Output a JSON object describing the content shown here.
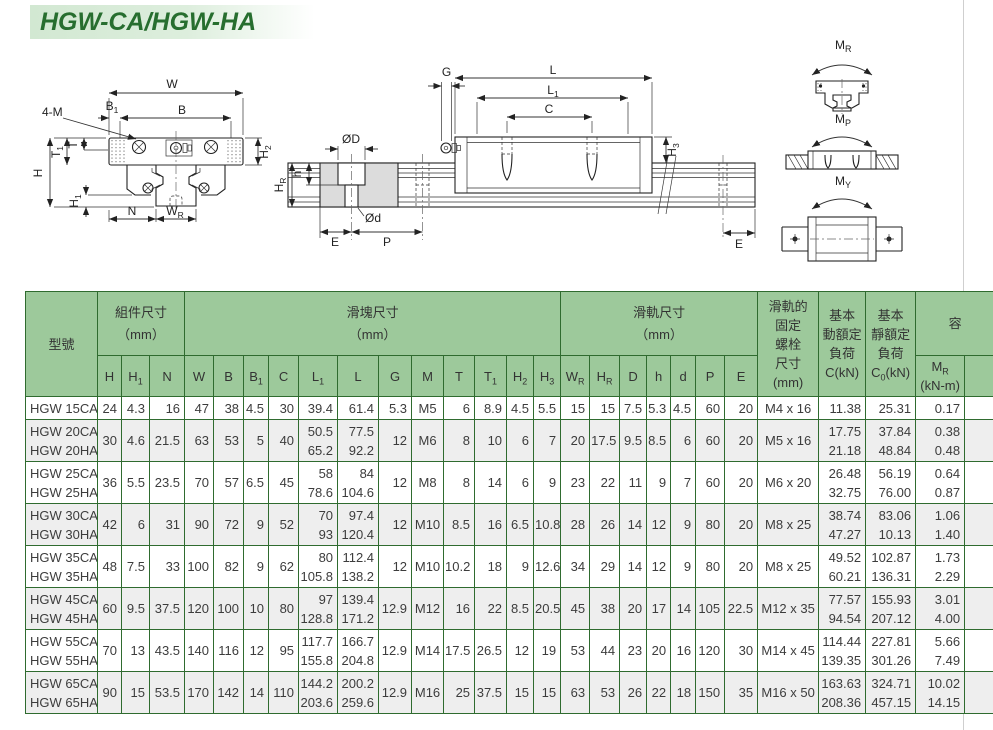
{
  "page": {
    "title": "HGW-CA/HGW-HA"
  },
  "colors": {
    "header_green": "#9dc99b",
    "border_green": "#2f6b2f",
    "row_alt_gray": "#eeeeee",
    "title_green": "#276e2f",
    "title_bg": "#d2e8d2"
  },
  "drawings": {
    "front": {
      "four_m": "4-M",
      "w": "W",
      "b": "B",
      "b1": {
        "b": "B",
        "s": "1"
      },
      "h2": {
        "b": "H",
        "s": "2"
      },
      "t": "T",
      "t1": {
        "b": "T",
        "s": "1"
      },
      "h": "H",
      "h1": {
        "b": "H",
        "s": "1"
      },
      "n": "N",
      "wr": {
        "b": "W",
        "s": "R"
      }
    },
    "side": {
      "g": "G",
      "l": "L",
      "l1": {
        "b": "L",
        "s": "1"
      },
      "c": "C",
      "h3": {
        "b": "H",
        "s": "3"
      },
      "dia_big": "ØD",
      "h_small": "h",
      "dia_small": "Ød",
      "hr": {
        "b": "H",
        "s": "R"
      },
      "e_left": "E",
      "p": "P",
      "e_right": "E"
    },
    "moments": {
      "mr": {
        "b": "M",
        "s": "R"
      },
      "mp": {
        "b": "M",
        "s": "P"
      },
      "my": {
        "b": "M",
        "s": "Y"
      }
    }
  },
  "table": {
    "headers": {
      "model": "型號",
      "assembly": [
        "組件尺寸",
        "（mm）"
      ],
      "block": [
        "滑塊尺寸",
        "（mm）"
      ],
      "rail": [
        "滑軌尺寸",
        "（mm）"
      ],
      "bolt": [
        "滑軌的",
        "固定",
        "螺栓",
        "尺寸",
        "(mm)"
      ],
      "dyn": [
        "基本",
        "動額定",
        "負荷",
        "C(kN)"
      ],
      "stat": [
        "基本",
        "靜額定",
        "負荷"
      ],
      "stat_c": {
        "base": "C",
        "sub": "0",
        "rest": "(kN)"
      },
      "moment": "容",
      "mr": {
        "base": "M",
        "sub": "R",
        "unit": "(kN-m)"
      },
      "sub": [
        {
          "b": "H"
        },
        {
          "b": "H",
          "s": "1"
        },
        {
          "b": "N"
        },
        {
          "b": "W"
        },
        {
          "b": "B"
        },
        {
          "b": "B",
          "s": "1"
        },
        {
          "b": "C"
        },
        {
          "b": "L",
          "s": "1"
        },
        {
          "b": "L"
        },
        {
          "b": "G"
        },
        {
          "b": "M"
        },
        {
          "b": "T"
        },
        {
          "b": "T",
          "s": "1"
        },
        {
          "b": "H",
          "s": "2"
        },
        {
          "b": "H",
          "s": "3"
        },
        {
          "b": "W",
          "s": "R"
        },
        {
          "b": "H",
          "s": "R"
        },
        {
          "b": "D"
        },
        {
          "b": "h"
        },
        {
          "b": "d"
        },
        {
          "b": "P"
        },
        {
          "b": "E"
        }
      ]
    },
    "rows": [
      {
        "model": [
          "HGW 15CA"
        ],
        "dims": [
          [
            "24"
          ],
          [
            "4.3"
          ],
          [
            "16"
          ],
          [
            "47"
          ],
          [
            "38"
          ],
          [
            "4.5"
          ],
          [
            "30"
          ],
          [
            "39.4"
          ],
          [
            "61.4"
          ],
          [
            "5.3"
          ],
          [
            "M5"
          ],
          [
            "6"
          ],
          [
            "8.9"
          ],
          [
            "4.5"
          ],
          [
            "5.5"
          ],
          [
            "15"
          ],
          [
            "15"
          ],
          [
            "7.5"
          ],
          [
            "5.3"
          ],
          [
            "4.5"
          ],
          [
            "60"
          ],
          [
            "20"
          ]
        ],
        "bolt": "M4 x 16",
        "c": [
          "11.38"
        ],
        "c0": [
          "25.31"
        ],
        "mr": [
          "0.17"
        ]
      },
      {
        "model": [
          "HGW 20CA",
          "HGW 20HA"
        ],
        "dims": [
          [
            "30"
          ],
          [
            "4.6"
          ],
          [
            "21.5"
          ],
          [
            "63"
          ],
          [
            "53"
          ],
          [
            "5"
          ],
          [
            "40"
          ],
          [
            "50.5",
            "65.2"
          ],
          [
            "77.5",
            "92.2"
          ],
          [
            "12"
          ],
          [
            "M6"
          ],
          [
            "8"
          ],
          [
            "10"
          ],
          [
            "6"
          ],
          [
            "7"
          ],
          [
            "20"
          ],
          [
            "17.5"
          ],
          [
            "9.5"
          ],
          [
            "8.5"
          ],
          [
            "6"
          ],
          [
            "60"
          ],
          [
            "20"
          ]
        ],
        "bolt": "M5 x 16",
        "c": [
          "17.75",
          "21.18"
        ],
        "c0": [
          "37.84",
          "48.84"
        ],
        "mr": [
          "0.38",
          "0.48"
        ]
      },
      {
        "model": [
          "HGW 25CA",
          "HGW 25HA"
        ],
        "dims": [
          [
            "36"
          ],
          [
            "5.5"
          ],
          [
            "23.5"
          ],
          [
            "70"
          ],
          [
            "57"
          ],
          [
            "6.5"
          ],
          [
            "45"
          ],
          [
            "58",
            "78.6"
          ],
          [
            "84",
            "104.6"
          ],
          [
            "12"
          ],
          [
            "M8"
          ],
          [
            "8"
          ],
          [
            "14"
          ],
          [
            "6"
          ],
          [
            "9"
          ],
          [
            "23"
          ],
          [
            "22"
          ],
          [
            "11"
          ],
          [
            "9"
          ],
          [
            "7"
          ],
          [
            "60"
          ],
          [
            "20"
          ]
        ],
        "bolt": "M6 x 20",
        "c": [
          "26.48",
          "32.75"
        ],
        "c0": [
          "56.19",
          "76.00"
        ],
        "mr": [
          "0.64",
          "0.87"
        ]
      },
      {
        "model": [
          "HGW 30CA",
          "HGW 30HA"
        ],
        "dims": [
          [
            "42"
          ],
          [
            "6"
          ],
          [
            "31"
          ],
          [
            "90"
          ],
          [
            "72"
          ],
          [
            "9"
          ],
          [
            "52"
          ],
          [
            "70",
            "93"
          ],
          [
            "97.4",
            "120.4"
          ],
          [
            "12"
          ],
          [
            "M10"
          ],
          [
            "8.5"
          ],
          [
            "16"
          ],
          [
            "6.5"
          ],
          [
            "10.8"
          ],
          [
            "28"
          ],
          [
            "26"
          ],
          [
            "14"
          ],
          [
            "12"
          ],
          [
            "9"
          ],
          [
            "80"
          ],
          [
            "20"
          ]
        ],
        "bolt": "M8 x 25",
        "c": [
          "38.74",
          "47.27"
        ],
        "c0": [
          "83.06",
          "10.13"
        ],
        "mr": [
          "1.06",
          "1.40"
        ]
      },
      {
        "model": [
          "HGW 35CA",
          "HGW 35HA"
        ],
        "dims": [
          [
            "48"
          ],
          [
            "7.5"
          ],
          [
            "33"
          ],
          [
            "100"
          ],
          [
            "82"
          ],
          [
            "9"
          ],
          [
            "62"
          ],
          [
            "80",
            "105.8"
          ],
          [
            "112.4",
            "138.2"
          ],
          [
            "12"
          ],
          [
            "M10"
          ],
          [
            "10.2"
          ],
          [
            "18"
          ],
          [
            "9"
          ],
          [
            "12.6"
          ],
          [
            "34"
          ],
          [
            "29"
          ],
          [
            "14"
          ],
          [
            "12"
          ],
          [
            "9"
          ],
          [
            "80"
          ],
          [
            "20"
          ]
        ],
        "bolt": "M8 x 25",
        "c": [
          "49.52",
          "60.21"
        ],
        "c0": [
          "102.87",
          "136.31"
        ],
        "mr": [
          "1.73",
          "2.29"
        ]
      },
      {
        "model": [
          "HGW 45CA",
          "HGW 45HA"
        ],
        "dims": [
          [
            "60"
          ],
          [
            "9.5"
          ],
          [
            "37.5"
          ],
          [
            "120"
          ],
          [
            "100"
          ],
          [
            "10"
          ],
          [
            "80"
          ],
          [
            "97",
            "128.8"
          ],
          [
            "139.4",
            "171.2"
          ],
          [
            "12.9"
          ],
          [
            "M12"
          ],
          [
            "16"
          ],
          [
            "22"
          ],
          [
            "8.5"
          ],
          [
            "20.5"
          ],
          [
            "45"
          ],
          [
            "38"
          ],
          [
            "20"
          ],
          [
            "17"
          ],
          [
            "14"
          ],
          [
            "105"
          ],
          [
            "22.5"
          ]
        ],
        "bolt": "M12 x 35",
        "c": [
          "77.57",
          "94.54"
        ],
        "c0": [
          "155.93",
          "207.12"
        ],
        "mr": [
          "3.01",
          "4.00"
        ]
      },
      {
        "model": [
          "HGW 55CA",
          "HGW 55HA"
        ],
        "dims": [
          [
            "70"
          ],
          [
            "13"
          ],
          [
            "43.5"
          ],
          [
            "140"
          ],
          [
            "116"
          ],
          [
            "12"
          ],
          [
            "95"
          ],
          [
            "117.7",
            "155.8"
          ],
          [
            "166.7",
            "204.8"
          ],
          [
            "12.9"
          ],
          [
            "M14"
          ],
          [
            "17.5"
          ],
          [
            "26.5"
          ],
          [
            "12"
          ],
          [
            "19"
          ],
          [
            "53"
          ],
          [
            "44"
          ],
          [
            "23"
          ],
          [
            "20"
          ],
          [
            "16"
          ],
          [
            "120"
          ],
          [
            "30"
          ]
        ],
        "bolt": "M14 x 45",
        "c": [
          "114.44",
          "139.35"
        ],
        "c0": [
          "227.81",
          "301.26"
        ],
        "mr": [
          "5.66",
          "7.49"
        ]
      },
      {
        "model": [
          "HGW 65CA",
          "HGW 65HA"
        ],
        "dims": [
          [
            "90"
          ],
          [
            "15"
          ],
          [
            "53.5"
          ],
          [
            "170"
          ],
          [
            "142"
          ],
          [
            "14"
          ],
          [
            "110"
          ],
          [
            "144.2",
            "203.6"
          ],
          [
            "200.2",
            "259.6"
          ],
          [
            "12.9"
          ],
          [
            "M16"
          ],
          [
            "25"
          ],
          [
            "37.5"
          ],
          [
            "15"
          ],
          [
            "15"
          ],
          [
            "63"
          ],
          [
            "53"
          ],
          [
            "26"
          ],
          [
            "22"
          ],
          [
            "18"
          ],
          [
            "150"
          ],
          [
            "35"
          ]
        ],
        "bolt": "M16 x 50",
        "c": [
          "163.63",
          "208.36"
        ],
        "c0": [
          "324.71",
          "457.15"
        ],
        "mr": [
          "10.02",
          "14.15"
        ]
      }
    ]
  }
}
